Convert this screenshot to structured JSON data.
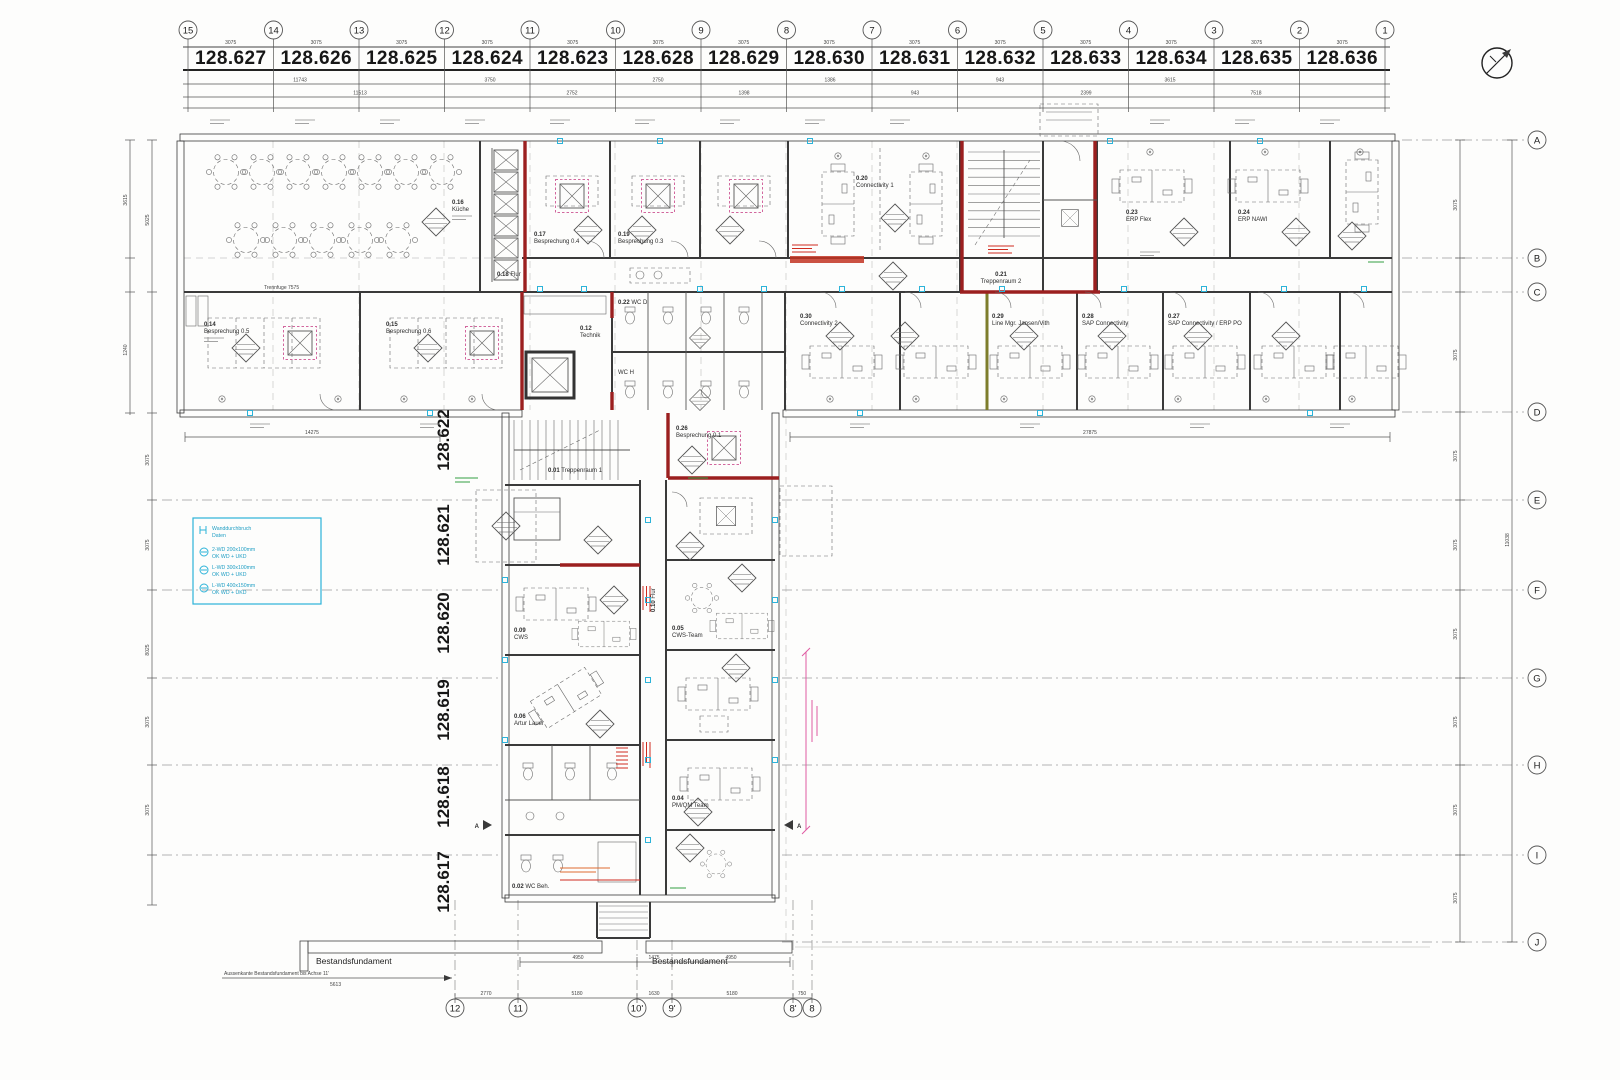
{
  "grid": {
    "top_bubbles": [
      "15",
      "14",
      "13",
      "12",
      "11",
      "10",
      "9",
      "8",
      "7",
      "6",
      "5",
      "4",
      "3",
      "2",
      "1"
    ],
    "top_labels": [
      "128.627",
      "128.626",
      "128.625",
      "128.624",
      "128.623",
      "128.628",
      "128.629",
      "128.630",
      "128.631",
      "128.632",
      "128.633",
      "128.634",
      "128.635",
      "128.636"
    ],
    "right_bubbles": [
      "A",
      "B",
      "C",
      "D",
      "E",
      "F",
      "G",
      "H",
      "I",
      "J"
    ],
    "bottom_bubbles": [
      "12",
      "11",
      "10'",
      "9'",
      "8'",
      "8"
    ],
    "south_labels": [
      "128.622",
      "128.621",
      "128.620",
      "128.619",
      "128.618",
      "128.617"
    ]
  },
  "dims": {
    "spacing": "3075",
    "top_chain": [
      "11743",
      "3750",
      "2750",
      "1386",
      "943",
      "3615"
    ],
    "top_chain2": [
      "11513",
      "2752",
      "1398",
      "943",
      "2399",
      "7518"
    ],
    "left_chain": [
      "3615",
      "1240",
      "5025",
      "8025"
    ],
    "right_total": "11038",
    "south_total": "14275",
    "north_total": "27875",
    "bottom_chain": [
      "2770",
      "5180",
      "1630",
      "5180",
      "750"
    ],
    "bottom_chain2": [
      "4950",
      "1475",
      "4950"
    ],
    "trennfuge": "Trennfuge 7575",
    "foundation_note": "Aussenkante Bestandsfundament bis Achse 11'",
    "foundation_note_value": "5613"
  },
  "annotations": {
    "foundation_label": "Bestandsfundament",
    "section_marker": "A"
  },
  "legend": {
    "title_line1": "Wanddurchbruch",
    "title_line2": "Daten",
    "items": [
      {
        "l1": "2-WD 200x100mm",
        "l2": "OK WD + UKD"
      },
      {
        "l1": "L-WD 300x100mm",
        "l2": "OK WD + UKD"
      },
      {
        "l1": "L-WD 400x150mm",
        "l2": "OK WD + UKD"
      }
    ]
  },
  "rooms": {
    "r016": {
      "num": "0.16",
      "name": "Küche"
    },
    "r017": {
      "num": "0.17",
      "name": "Besprechung 0.4"
    },
    "r019": {
      "num": "0.19",
      "name": "Besprechung 0.3"
    },
    "r018": {
      "num": "0.18",
      "name": "Flur"
    },
    "r020": {
      "num": "0.20",
      "name": "Connectivity 1"
    },
    "r021": {
      "num": "0.21",
      "name": "Treppenraum 2"
    },
    "r023": {
      "num": "0.23",
      "name": "ERP Flex"
    },
    "r024": {
      "num": "0.24",
      "name": "ERP NAWI"
    },
    "r030": {
      "num": "0.30",
      "name": "Connectivity 2"
    },
    "r029": {
      "num": "0.29",
      "name": "Line Mgr. Jansen/Vith"
    },
    "r028": {
      "num": "0.28",
      "name": "SAP Connectivity"
    },
    "r027": {
      "num": "0.27",
      "name": "SAP Connectivity / ERP PO"
    },
    "r014": {
      "num": "0.14",
      "name": "Besprechung 0.5"
    },
    "r015": {
      "num": "0.15",
      "name": "Besprechung 0.6"
    },
    "r026": {
      "num": "0.26",
      "name": "Besprechung 0.1"
    },
    "r001": {
      "num": "0.01",
      "name": "Treppenraum 1"
    },
    "r010": {
      "num": "0.10",
      "name": "Flur"
    },
    "r012": {
      "num": "0.12",
      "name": "Technik"
    },
    "r009": {
      "num": "0.09",
      "name": "CWS"
    },
    "r005": {
      "num": "0.05",
      "name": "CWS-Team"
    },
    "r006": {
      "num": "0.06",
      "name": "Artur Lauer"
    },
    "r004": {
      "num": "0.04",
      "name": "PM/QM Team"
    },
    "r002": {
      "num": "0.02",
      "name": "WC Beh."
    },
    "r022": {
      "num": "0.22",
      "name": "WC D"
    },
    "rwch": {
      "num": "",
      "name": "WC H"
    }
  }
}
